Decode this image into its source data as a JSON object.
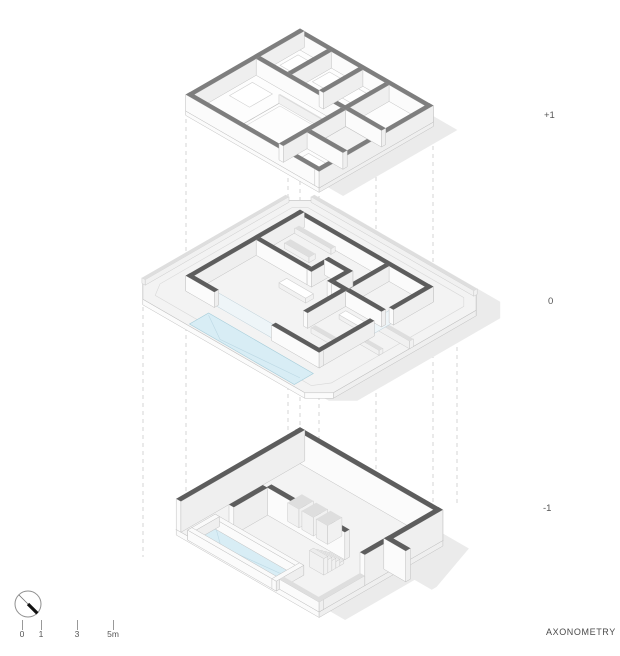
{
  "drawing_title": "AXONOMETRY",
  "levels": [
    {
      "label": "+1"
    },
    {
      "label": "0"
    },
    {
      "label": "-1"
    }
  ],
  "scale_bar": {
    "labels": [
      "0",
      "1",
      "3",
      "5m"
    ]
  },
  "colors": {
    "wall_top": "#7e7e7e",
    "wall_top_dark": "#5d5d5d",
    "wall_face": "#efefef",
    "wall_face_light": "#fbfbfb",
    "floor": "#fdfdfd",
    "ground": "#f3f3f3",
    "lite": "#dedede",
    "water": "#d8edf5",
    "water_edge": "#a5ccd9",
    "line": "#c0c0c0",
    "dash": "#cccccc",
    "shadow": "#ebebeb",
    "text": "#555555",
    "arrow": "#111111"
  }
}
